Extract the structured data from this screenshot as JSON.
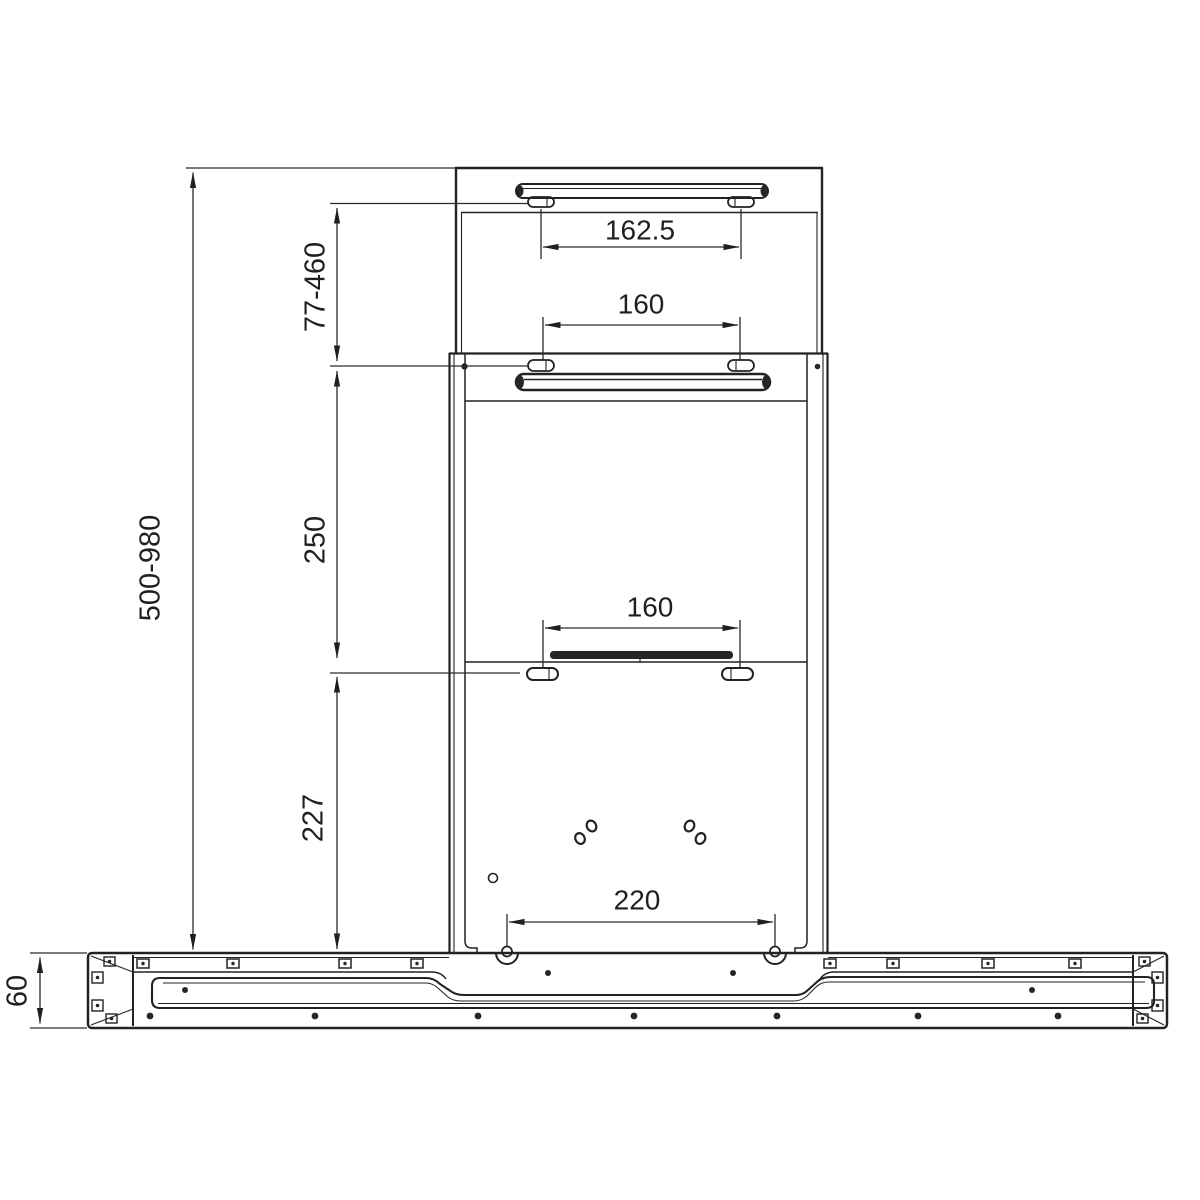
{
  "drawing": {
    "type": "installation-dimension-drawing",
    "subject": "wall-mounted chimney cooker hood, front view with mounting brackets",
    "units": "mm",
    "background_color": "#ffffff",
    "line_color": "#222222",
    "labels": {
      "top_bracket_hole_spacing": "162.5",
      "upper_chimney_hole_spacing": "160",
      "upper_chimney_height_range": "77-460",
      "mid_section_height": "250",
      "lower_bracket_hole_spacing": "160",
      "lower_section_height": "227",
      "overall_height_range": "500-980",
      "hood_keyhole_spacing": "220",
      "hood_body_height": "60"
    }
  }
}
